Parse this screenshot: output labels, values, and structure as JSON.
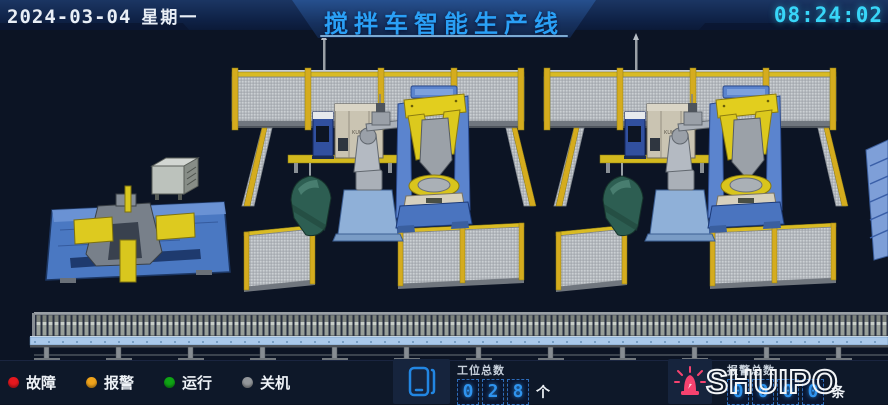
{
  "header": {
    "date": "2024-03-04",
    "weekday": "星期一",
    "title": "搅拌车智能生产线",
    "time": "08:24:02"
  },
  "scene": {
    "cabinet_label": "KUKA"
  },
  "status_legend": {
    "items": [
      {
        "label": "故障",
        "color": "#e5181f"
      },
      {
        "label": "报警",
        "color": "#f0a41c"
      },
      {
        "label": "运行",
        "color": "#0fa415"
      },
      {
        "label": "关机",
        "color": "#93979b"
      }
    ]
  },
  "station_counter": {
    "label": "工位总数",
    "digits": [
      "0",
      "2",
      "8"
    ],
    "unit": "个"
  },
  "alarm_counter": {
    "label": "报警总数",
    "digits": [
      "0",
      "0",
      "0",
      "0"
    ],
    "unit": "条"
  },
  "brand": {
    "logo": "SHUIPO"
  },
  "colors": {
    "title": "#2aa0f6",
    "time": "#38d6f8"
  }
}
